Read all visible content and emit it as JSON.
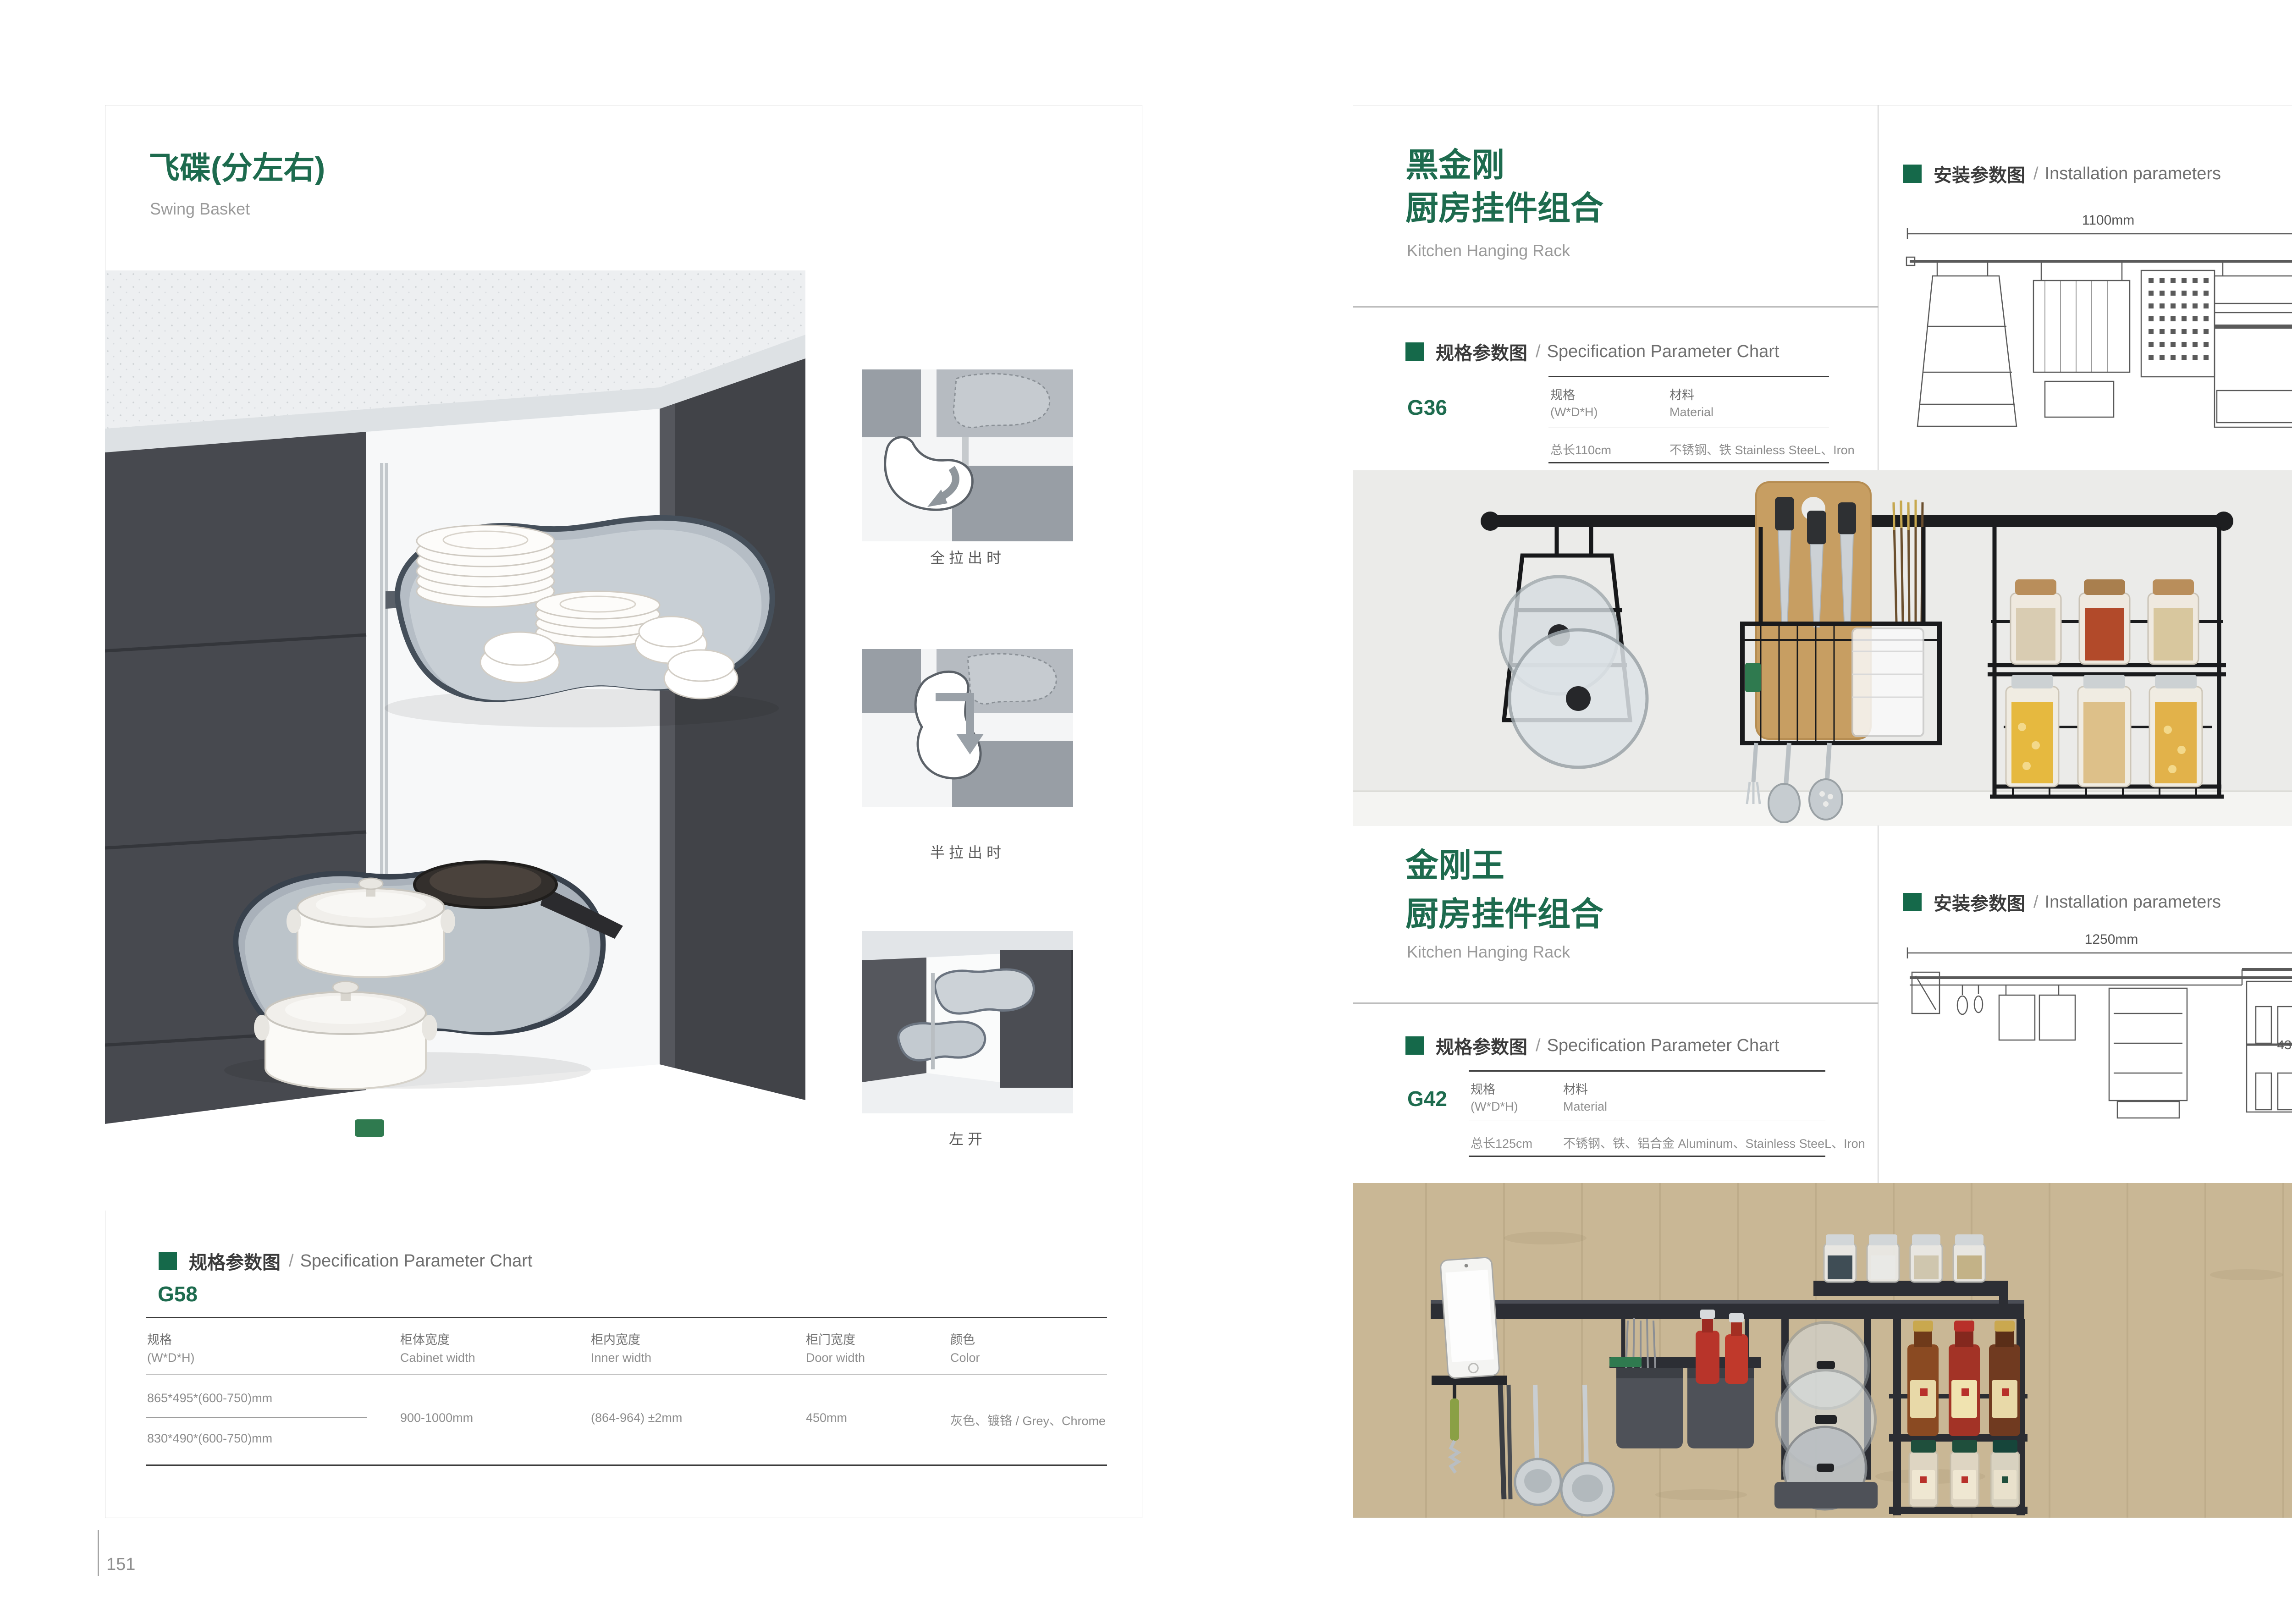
{
  "page_left": {
    "title": "飞碟(分左右)",
    "subtitle": "Swing Basket",
    "diagram_captions": [
      "全拉出时",
      "半拉出时",
      "左开"
    ],
    "spec_header": {
      "zh": "规格参数图",
      "sep": "/",
      "en": "Specification Parameter Chart"
    },
    "product_code": "G58",
    "table": {
      "columns": [
        {
          "zh": "规格",
          "en": "(W*D*H)"
        },
        {
          "zh": "柜体宽度",
          "en": "Cabinet width"
        },
        {
          "zh": "柜内宽度",
          "en": "Inner width"
        },
        {
          "zh": "柜门宽度",
          "en": "Door width"
        },
        {
          "zh": "颜色",
          "en": "Color"
        }
      ],
      "rows": {
        "spec_1": "865*495*(600-750)mm",
        "spec_2": "830*490*(600-750)mm",
        "cabinet_width": "900-1000mm",
        "inner_width": "(864-964) ±2mm",
        "door_width": "450mm",
        "color": "灰色、镀铬 / Grey、Chrome"
      }
    },
    "page_number": "151"
  },
  "page_right": {
    "section_top": {
      "title_line1": "黑金刚",
      "title_line2": "厨房挂件组合",
      "subtitle": "Kitchen Hanging Rack",
      "install_header": {
        "zh": "安装参数图",
        "sep": "/",
        "en": "Installation parameters"
      },
      "drawing": {
        "width_label": "1100mm",
        "height_label": "420mm"
      },
      "spec_header": {
        "zh": "规格参数图",
        "sep": "/",
        "en": "Specification Parameter Chart"
      },
      "product_code": "G36",
      "table": {
        "col1_zh": "规格",
        "col1_en": "(W*D*H)",
        "col2_zh": "材料",
        "col2_en": "Material",
        "spec": "总长110cm",
        "material": "不锈钢、铁  Stainless SteeL、Iron"
      }
    },
    "section_bottom": {
      "title_line1": "金刚王",
      "title_line2": "厨房挂件组合",
      "subtitle": "Kitchen Hanging Rack",
      "install_header": {
        "zh": "安装参数图",
        "sep": "/",
        "en": "Installation parameters"
      },
      "drawing": {
        "width_label": "1250mm",
        "height_label": "430mm"
      },
      "spec_header": {
        "zh": "规格参数图",
        "sep": "/",
        "en": "Specification Parameter Chart"
      },
      "product_code": "G42",
      "table": {
        "col1_zh": "规格",
        "col1_en": "(W*D*H)",
        "col2_zh": "材料",
        "col2_en": "Material",
        "spec": "总长125cm",
        "material": "不锈钢、铁、铝合金  Aluminum、Stainless SteeL、Iron"
      }
    },
    "page_number": "152"
  }
}
